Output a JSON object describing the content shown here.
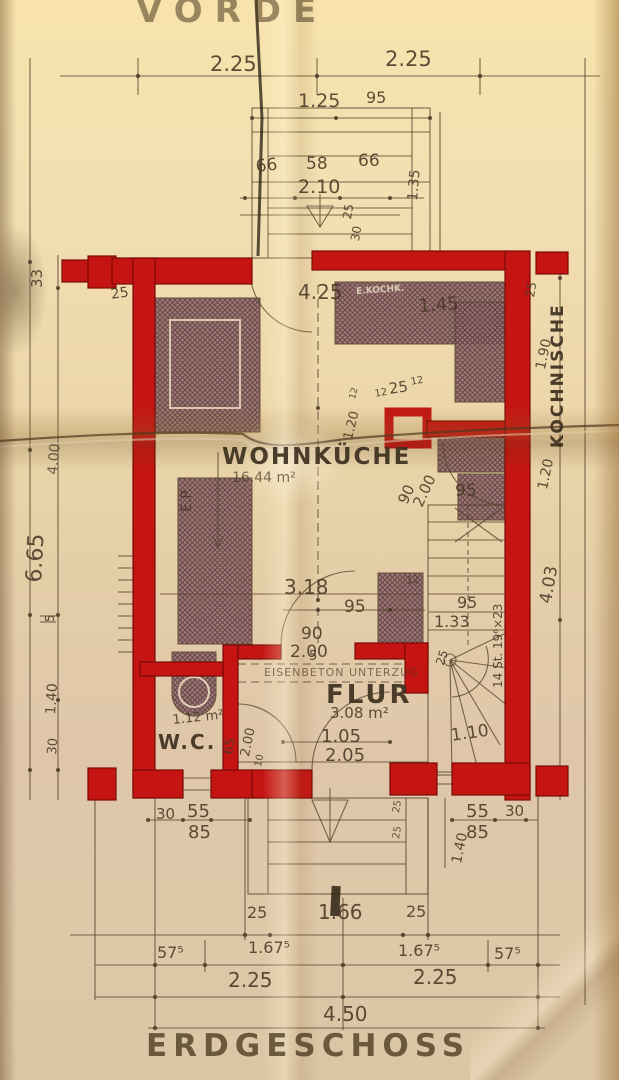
{
  "drawing": {
    "title_top": "VORDE",
    "title_bottom": "ERDGESCHOSS",
    "rooms": [
      {
        "name": "WOHNKÜCHE",
        "area": "16.44 m²"
      },
      {
        "name": "KOCHNISCHE",
        "area": ""
      },
      {
        "name": "FLUR",
        "area": "3.08 m²"
      },
      {
        "name": "W.C.",
        "area": "1.12 m²"
      }
    ],
    "notes": [
      "EISENBETON UNTERZUG",
      "14 St. 19⁶×23",
      "E.P."
    ]
  },
  "colors": {
    "wall_red": "#c41512",
    "pencil": "#5a462f",
    "pencil_text": "#4a3826",
    "paper": "#ecd9af"
  },
  "labels": [
    {
      "n": "title-top",
      "t": "VORDE",
      "x": 136,
      "y": -6,
      "fs": 34,
      "ls": 12,
      "cls": "title",
      "op": 0.55
    },
    {
      "n": "dim-225-top-left",
      "t": "2.25",
      "x": 210,
      "y": 54,
      "fs": 21
    },
    {
      "n": "dim-225-top-right",
      "t": "2.25",
      "x": 385,
      "y": 49,
      "fs": 21
    },
    {
      "n": "dim-125-porch",
      "t": "1.25",
      "x": 298,
      "y": 92,
      "fs": 19
    },
    {
      "n": "dim-95-porch",
      "t": "95",
      "x": 366,
      "y": 90,
      "fs": 16
    },
    {
      "n": "dim-66-left",
      "t": "66",
      "x": 255,
      "y": 159,
      "fs": 17,
      "rot": -6
    },
    {
      "n": "dim-58-porch",
      "t": "58",
      "x": 306,
      "y": 156,
      "fs": 17
    },
    {
      "n": "dim-66-right",
      "t": "66",
      "x": 358,
      "y": 153,
      "fs": 17
    },
    {
      "n": "dim-210-porch",
      "t": "2.10",
      "x": 298,
      "y": 178,
      "fs": 19
    },
    {
      "n": "dim-135-porch",
      "t": "1.35",
      "x": 406,
      "y": 200,
      "fs": 14,
      "rot": -85
    },
    {
      "n": "dim-25-porch",
      "t": "25",
      "x": 341,
      "y": 218,
      "fs": 12,
      "rot": -80
    },
    {
      "n": "dim-30-porch",
      "t": "30",
      "x": 349,
      "y": 240,
      "fs": 12,
      "rot": -80
    },
    {
      "n": "dim-33-left",
      "t": "33",
      "x": 30,
      "y": 288,
      "fs": 15,
      "rot": -90
    },
    {
      "n": "dim-25-left-wall",
      "t": "25",
      "x": 110,
      "y": 288,
      "fs": 14,
      "rot": -8
    },
    {
      "n": "dim-425",
      "t": "4.25",
      "x": 298,
      "y": 282,
      "fs": 20
    },
    {
      "n": "dim-145",
      "t": "1.45",
      "x": 418,
      "y": 298,
      "fs": 18,
      "rot": -4
    },
    {
      "n": "dim-25-right-top",
      "t": "25",
      "x": 524,
      "y": 296,
      "fs": 12,
      "rot": -80
    },
    {
      "n": "room-kochnische",
      "t": "KOCHNISCHE",
      "x": 550,
      "y": 448,
      "fs": 17,
      "rot": -90,
      "ls": 2,
      "cls": "room"
    },
    {
      "n": "dim-190-right",
      "t": "1.90",
      "x": 534,
      "y": 368,
      "fs": 14,
      "rot": -78
    },
    {
      "n": "label-kitchen-fixture",
      "t": "E.KOCHK.",
      "x": 356,
      "y": 288,
      "fs": 9,
      "rot": -4,
      "cls": "onhatch",
      "op": 0.85
    },
    {
      "n": "dim-12-a",
      "t": "12",
      "x": 374,
      "y": 390,
      "fs": 10,
      "rot": -10
    },
    {
      "n": "dim-25-chimney",
      "t": "25",
      "x": 388,
      "y": 382,
      "fs": 15,
      "rot": -8
    },
    {
      "n": "dim-12-b",
      "t": "12",
      "x": 410,
      "y": 378,
      "fs": 10,
      "rot": -10
    },
    {
      "n": "dim-120-chimney",
      "t": "1.20",
      "x": 342,
      "y": 438,
      "fs": 13,
      "rot": -76
    },
    {
      "n": "dim-12-c",
      "t": "12",
      "x": 349,
      "y": 398,
      "fs": 9,
      "rot": -76
    },
    {
      "n": "label-ep",
      "t": "E.P.",
      "x": 180,
      "y": 512,
      "fs": 14,
      "rot": -90
    },
    {
      "n": "room-wohnkueche",
      "t": "WOHNKÜCHE",
      "x": 222,
      "y": 446,
      "fs": 23,
      "ls": 2,
      "cls": "room"
    },
    {
      "n": "area-wohnkueche",
      "t": "16.44 m²",
      "x": 232,
      "y": 471,
      "fs": 14,
      "op": 0.7
    },
    {
      "n": "dim-90-door-kn",
      "t": "90",
      "x": 396,
      "y": 500,
      "fs": 15,
      "rot": -65
    },
    {
      "n": "dim-200-door-kn",
      "t": "2.00",
      "x": 411,
      "y": 503,
      "fs": 15,
      "rot": -65
    },
    {
      "n": "dim-95-door",
      "t": "95",
      "x": 455,
      "y": 483,
      "fs": 17
    },
    {
      "n": "dim-120-right",
      "t": "1.20",
      "x": 536,
      "y": 488,
      "fs": 14,
      "rot": -78
    },
    {
      "n": "dim-403-right",
      "t": "4.03",
      "x": 538,
      "y": 602,
      "fs": 17,
      "rot": -80
    },
    {
      "n": "dim-400-left",
      "t": "4.00",
      "x": 46,
      "y": 474,
      "fs": 14,
      "rot": -85,
      "op": 0.75
    },
    {
      "n": "dim-665-left",
      "t": "6.65",
      "x": 24,
      "y": 582,
      "fs": 22,
      "rot": -87
    },
    {
      "n": "dim-5-left",
      "t": "5",
      "x": 44,
      "y": 622,
      "fs": 12,
      "rot": -90
    },
    {
      "n": "dim-140-left",
      "t": "1.40",
      "x": 44,
      "y": 714,
      "fs": 14,
      "rot": -86
    },
    {
      "n": "dim-30-left",
      "t": "30",
      "x": 46,
      "y": 754,
      "fs": 13,
      "rot": -85
    },
    {
      "n": "dim-318",
      "t": "3.18",
      "x": 284,
      "y": 577,
      "fs": 20
    },
    {
      "n": "dim-95-mid",
      "t": "95",
      "x": 344,
      "y": 599,
      "fs": 17
    },
    {
      "n": "dim-12-heater",
      "t": "12",
      "x": 406,
      "y": 577,
      "fs": 10,
      "rot": -8,
      "op": 0.8
    },
    {
      "n": "dim-90-flurdoor",
      "t": "90",
      "x": 301,
      "y": 626,
      "fs": 17
    },
    {
      "n": "dim-200-flurdoor",
      "t": "2.00",
      "x": 290,
      "y": 644,
      "fs": 17
    },
    {
      "n": "dim-95-stair",
      "t": "95",
      "x": 457,
      "y": 595,
      "fs": 16
    },
    {
      "n": "dim-133-stair",
      "t": "1.33",
      "x": 434,
      "y": 614,
      "fs": 16
    },
    {
      "n": "dim-25-stair",
      "t": "25",
      "x": 434,
      "y": 663,
      "fs": 12,
      "rot": -72
    },
    {
      "n": "note-stairs",
      "t": "14 St. 19⁶×23",
      "x": 492,
      "y": 688,
      "fs": 12,
      "rot": -90
    },
    {
      "n": "dim-110-stair",
      "t": "1.10",
      "x": 450,
      "y": 728,
      "fs": 17,
      "rot": -8
    },
    {
      "n": "note-beam",
      "t": "EISENBETON UNTERZUG",
      "x": 264,
      "y": 667,
      "fs": 11,
      "ls": 1,
      "op": 0.65
    },
    {
      "n": "room-flur",
      "t": "FLUR",
      "x": 326,
      "y": 682,
      "fs": 26,
      "ls": 3,
      "cls": "room"
    },
    {
      "n": "area-flur",
      "t": "3.08 m²",
      "x": 330,
      "y": 706,
      "fs": 15
    },
    {
      "n": "dim-105",
      "t": "1.05",
      "x": 321,
      "y": 728,
      "fs": 18
    },
    {
      "n": "dim-205",
      "t": "2.05",
      "x": 325,
      "y": 747,
      "fs": 18
    },
    {
      "n": "area-wc",
      "t": "1.12 m²",
      "x": 172,
      "y": 714,
      "fs": 13,
      "rot": -6
    },
    {
      "n": "room-wc",
      "t": "W.C.",
      "x": 158,
      "y": 732,
      "fs": 20,
      "ls": 2,
      "cls": "room"
    },
    {
      "n": "dim-65-wc",
      "t": "65",
      "x": 222,
      "y": 753,
      "fs": 13,
      "rot": -78
    },
    {
      "n": "dim-200-wc",
      "t": "2.00",
      "x": 239,
      "y": 755,
      "fs": 13,
      "rot": -78
    },
    {
      "n": "dim-10-wc",
      "t": "10",
      "x": 254,
      "y": 766,
      "fs": 10,
      "rot": -78
    },
    {
      "n": "dim-5-wall",
      "t": "5",
      "x": 309,
      "y": 650,
      "fs": 13
    },
    {
      "n": "dim-30-bl",
      "t": "30",
      "x": 156,
      "y": 807,
      "fs": 15
    },
    {
      "n": "dim-55-bl",
      "t": "55",
      "x": 187,
      "y": 803,
      "fs": 18
    },
    {
      "n": "dim-85-bl",
      "t": "85",
      "x": 188,
      "y": 824,
      "fs": 18
    },
    {
      "n": "dim-55-br",
      "t": "55",
      "x": 466,
      "y": 803,
      "fs": 18
    },
    {
      "n": "dim-30-br",
      "t": "30",
      "x": 505,
      "y": 804,
      "fs": 15
    },
    {
      "n": "dim-85-br",
      "t": "85",
      "x": 466,
      "y": 824,
      "fs": 18
    },
    {
      "n": "dim-140-br",
      "t": "1.40",
      "x": 450,
      "y": 862,
      "fs": 14,
      "rot": -78
    },
    {
      "n": "dim-25-step-a",
      "t": "25",
      "x": 392,
      "y": 812,
      "fs": 10,
      "rot": -80,
      "op": 0.8
    },
    {
      "n": "dim-25-step-b",
      "t": "25",
      "x": 392,
      "y": 838,
      "fs": 10,
      "rot": -80,
      "op": 0.8
    },
    {
      "n": "dim-25-bsl",
      "t": "25",
      "x": 247,
      "y": 905,
      "fs": 16
    },
    {
      "n": "dim-166",
      "t": "1.66",
      "x": 318,
      "y": 902,
      "fs": 20
    },
    {
      "n": "dim-25-bsr",
      "t": "25",
      "x": 406,
      "y": 904,
      "fs": 16
    },
    {
      "n": "dim-575-a",
      "t": "57⁵",
      "x": 157,
      "y": 945,
      "fs": 16
    },
    {
      "n": "dim-1675-a",
      "t": "1.67⁵",
      "x": 248,
      "y": 940,
      "fs": 16
    },
    {
      "n": "dim-1675-b",
      "t": "1.67⁵",
      "x": 398,
      "y": 943,
      "fs": 16
    },
    {
      "n": "dim-575-b",
      "t": "57⁵",
      "x": 494,
      "y": 946,
      "fs": 16
    },
    {
      "n": "dim-225-bl",
      "t": "2.25",
      "x": 228,
      "y": 970,
      "fs": 20
    },
    {
      "n": "dim-225-br",
      "t": "2.25",
      "x": 413,
      "y": 967,
      "fs": 20
    },
    {
      "n": "dim-450",
      "t": "4.50",
      "x": 323,
      "y": 1004,
      "fs": 20
    },
    {
      "n": "title-bottom",
      "t": "ERDGESCHOSS",
      "x": 146,
      "y": 1031,
      "fs": 31,
      "ls": 6,
      "cls": "title"
    }
  ]
}
